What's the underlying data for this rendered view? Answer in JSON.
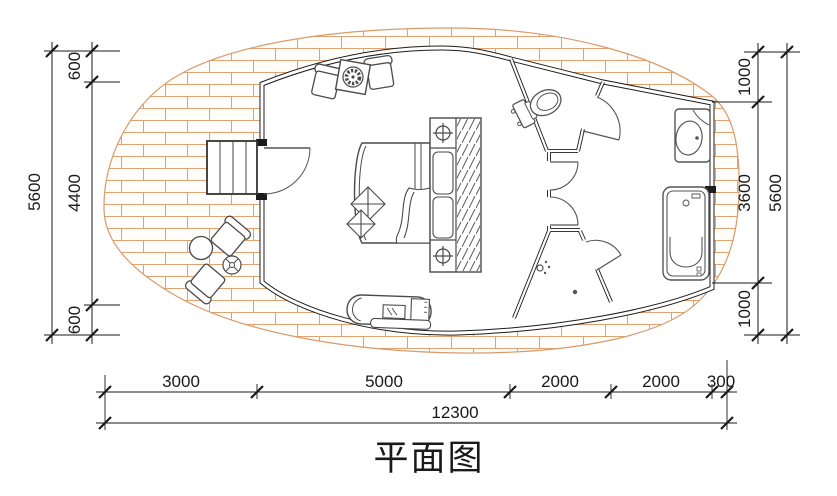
{
  "drawing": {
    "title": "平面图",
    "dims": {
      "left": {
        "overall": "5600",
        "segments": [
          "600",
          "4400",
          "600"
        ]
      },
      "right": {
        "overall": "5600",
        "segments": [
          "1000",
          "3600",
          "1000"
        ]
      },
      "bottom": {
        "overall": "12300",
        "segments": [
          "3000",
          "5000",
          "2000",
          "2000",
          "300"
        ]
      }
    },
    "colors": {
      "brick_line": "#dfa272",
      "wall": "#1c1c1c",
      "fixture": "#555555",
      "dimension": "#1a1a1a"
    }
  }
}
